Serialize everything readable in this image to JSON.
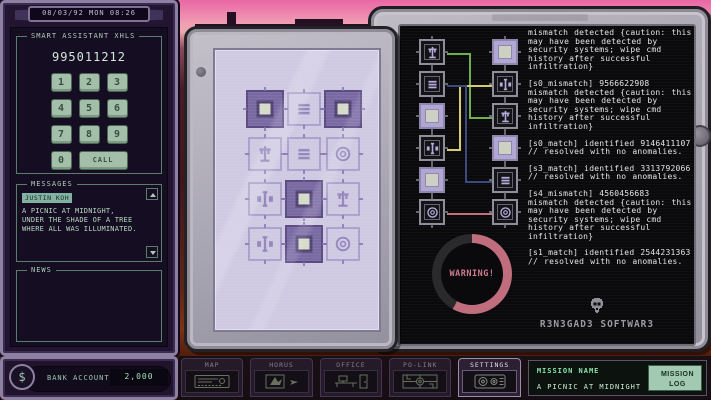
{
  "left_device": {
    "datetime": "08/03/92 MON 08:26",
    "assistant": {
      "title": "SMART ASSISTANT XHLS",
      "number_display": "995011212",
      "keys": [
        "1",
        "2",
        "3",
        "4",
        "5",
        "6",
        "7",
        "8",
        "9",
        "0"
      ],
      "call_label": "CALL"
    },
    "messages": {
      "title": "MESSAGES",
      "sender": "JUSTIN KOH",
      "body": "A PICNIC AT MIDNIGHT, UNDER THE SHADE OF A TREE WHERE ALL WAS ILLUMINATED."
    },
    "news": {
      "title": "NEWS"
    },
    "bank": {
      "currency_symbol": "$",
      "label": "BANK ACCOUNT",
      "value": "2,000"
    }
  },
  "puzzle": {
    "tiles": [
      {
        "variant": "dark",
        "glyph": "square"
      },
      {
        "variant": "light",
        "glyph": "lines"
      },
      {
        "variant": "dark",
        "glyph": "square"
      },
      {
        "variant": "light",
        "glyph": "scales"
      },
      {
        "variant": "light",
        "glyph": "lines"
      },
      {
        "variant": "light",
        "glyph": "target"
      },
      {
        "variant": "light",
        "glyph": "drone"
      },
      {
        "variant": "dark",
        "glyph": "square"
      },
      {
        "variant": "light",
        "glyph": "scales"
      },
      {
        "variant": "light",
        "glyph": "drone"
      },
      {
        "variant": "dark",
        "glyph": "square"
      },
      {
        "variant": "light",
        "glyph": "target"
      }
    ]
  },
  "terminal": {
    "chips_left": [
      {
        "variant": "dark",
        "glyph": "scales"
      },
      {
        "variant": "dark",
        "glyph": "lines"
      },
      {
        "variant": "light",
        "glyph": "square"
      },
      {
        "variant": "dark",
        "glyph": "drone"
      },
      {
        "variant": "light",
        "glyph": "square"
      },
      {
        "variant": "dark",
        "glyph": "target"
      }
    ],
    "chips_right": [
      {
        "variant": "light",
        "glyph": "square"
      },
      {
        "variant": "dark",
        "glyph": "drone"
      },
      {
        "variant": "dark",
        "glyph": "scales"
      },
      {
        "variant": "light",
        "glyph": "square"
      },
      {
        "variant": "dark",
        "glyph": "lines"
      },
      {
        "variant": "dark",
        "glyph": "target"
      }
    ],
    "wires": [
      {
        "color": "#6fae4d",
        "from": "left-1",
        "to": "right-3"
      },
      {
        "color": "#d8ca74",
        "from": "left-4",
        "to": "right-2"
      },
      {
        "color": "#3c4a7e",
        "from": "left-2",
        "to": "right-5"
      },
      {
        "color": "#c46e7e",
        "from": "left-6",
        "to": "right-6"
      }
    ],
    "log": [
      "mismatch detected {caution: this may have been detected by security systems; wipe cmd history after successful infiltration}",
      "[s0_mismatch] 9566622908 mismatch detected {caution: this may have been detected by security systems; wipe cmd history after successful infiltration}",
      "[s0_match] identified 9146411107 // resolved with no anomalies.",
      "[s3_match] identified 3313792066 // resolved with no anomalies.",
      "[s4_mismatch] 4560456683 mismatch detected {caution: this may have been detected by security systems; wipe cmd history after successful infiltration}",
      "[s1_match] identified 2544231363 // resolved with no anomalies."
    ],
    "warning": {
      "label": "WARNING!",
      "fill_percent": 58,
      "fill_color": "#c06d7d",
      "empty_color": "#2a2a2d"
    },
    "branding": "R3N3GAD3 SOFTWAR3"
  },
  "taskbar": {
    "tabs": [
      {
        "label": "MAP",
        "active": false
      },
      {
        "label": "HORUS",
        "active": false
      },
      {
        "label": "OFFICE",
        "active": false
      },
      {
        "label": "PO-LINK",
        "active": false
      },
      {
        "label": "SETTINGS",
        "active": true
      }
    ],
    "mission": {
      "name_label": "MISSION NAME",
      "name": "A PICNIC AT MIDNIGHT",
      "log_button": "MISSION LOG"
    }
  },
  "colors": {
    "ui_green": "#9fc7ae",
    "highlight_teal": "#82b3a2",
    "warning_pink": "#c06d7d",
    "log_text": "#e4e4e4"
  }
}
